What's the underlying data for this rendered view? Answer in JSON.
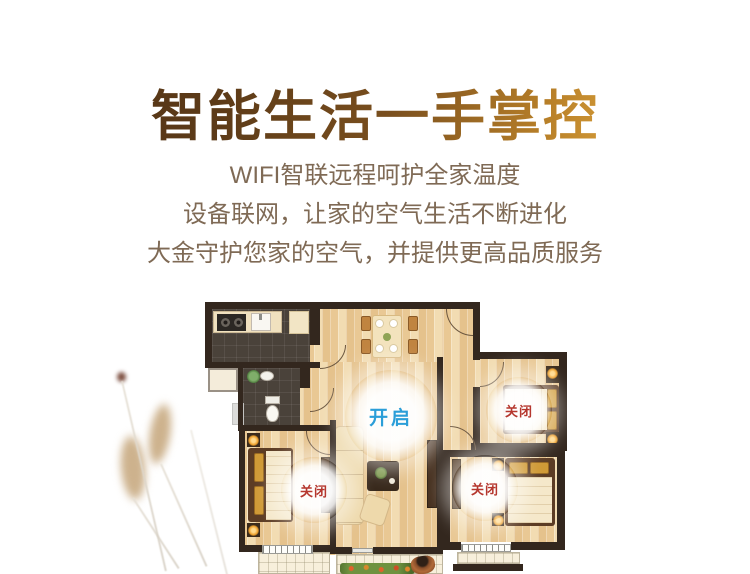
{
  "hero": {
    "title": "智能生活一手掌控",
    "subtitle_lines": [
      "WIFI智联远程呵护全家温度",
      "设备联网，让家的空气生活不断进化",
      "大金守护您家的空气，并提供更高品质服务"
    ]
  },
  "floorplan": {
    "statuses": [
      {
        "room": "living-room",
        "label": "开启",
        "state": "on",
        "color": "#2b9ed8"
      },
      {
        "room": "bedroom-top-right",
        "label": "关闭",
        "state": "off",
        "color": "#b5372e"
      },
      {
        "room": "bedroom-bottom-left",
        "label": "关闭",
        "state": "off",
        "color": "#b5372e"
      },
      {
        "room": "bedroom-bottom-right",
        "label": "关闭",
        "state": "off",
        "color": "#b5372e"
      }
    ]
  },
  "colors": {
    "title_gradient_start": "#4f3115",
    "title_gradient_end": "#eec05a",
    "subtitle_text": "#7f6a55",
    "status_on": "#2b9ed8",
    "status_off": "#b5372e",
    "wall": "#33271e",
    "wood_floor": "#eccf9f"
  }
}
